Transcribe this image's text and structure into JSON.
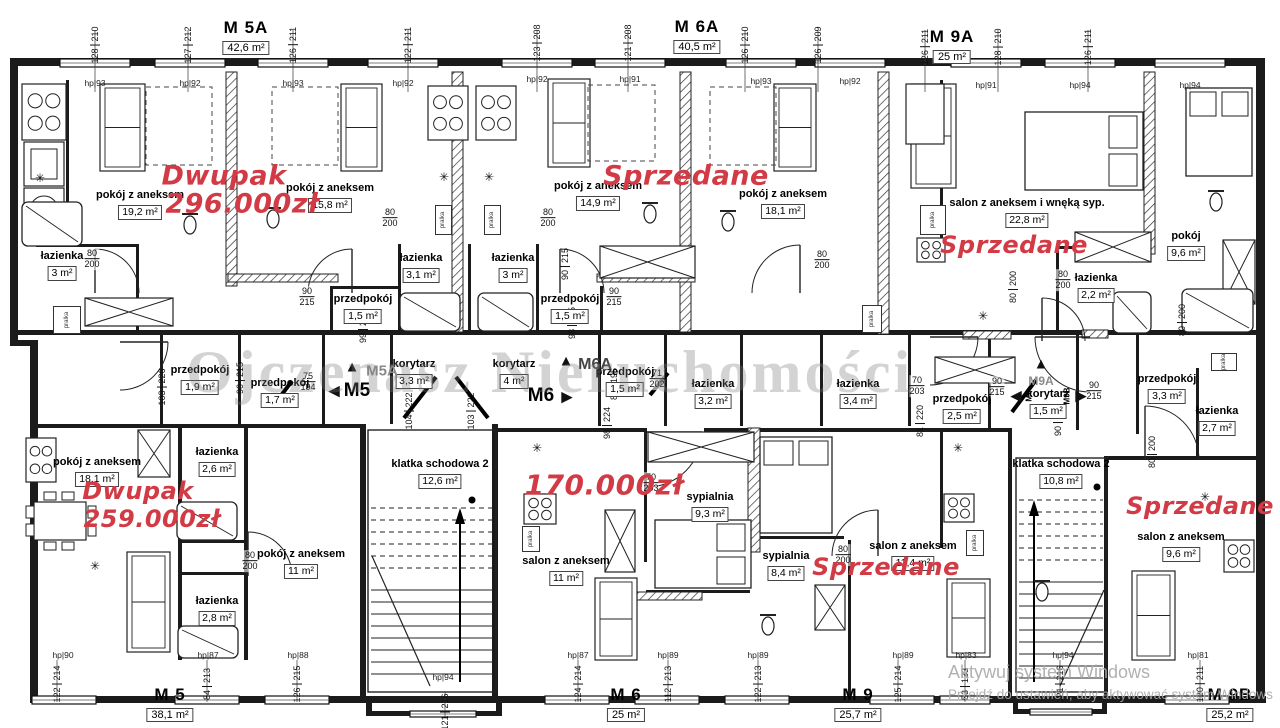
{
  "watermark": {
    "text": "Ojczenasz Nieruchomości"
  },
  "windows_notice": {
    "line1": "Aktywuj system Windows",
    "line2": "Przejdź do ustawień, aby aktywować system Windows"
  },
  "colors": {
    "annotation_red": "#d23b45",
    "wall_black": "#1b1b1b",
    "watermark_gray": "#7a7a7a"
  },
  "units": [
    {
      "name": "M 5A",
      "area": "42,6 m²",
      "x": 246,
      "y": 18
    },
    {
      "name": "M 6A",
      "area": "40,5 m²",
      "x": 697,
      "y": 17
    },
    {
      "name": "M 9A",
      "area": "25 m²",
      "x": 952,
      "y": 27
    },
    {
      "name": "M 5",
      "area": "38,1 m²",
      "x": 170,
      "y": 685
    },
    {
      "name": "M 6",
      "area": "25 m²",
      "x": 626,
      "y": 685
    },
    {
      "name": "M 9",
      "area": "25,7 m²",
      "x": 858,
      "y": 685
    },
    {
      "name": "M 9B",
      "area": "25,2 m²",
      "x": 1230,
      "y": 685
    }
  ],
  "rooms": [
    {
      "name": "pokój z aneksem",
      "area": "19,2 m²",
      "x": 140,
      "y": 190
    },
    {
      "name": "pokój z aneksem",
      "area": "15,8 m²",
      "x": 330,
      "y": 183
    },
    {
      "name": "pokój z aneksem",
      "area": "14,9 m²",
      "x": 598,
      "y": 181
    },
    {
      "name": "pokój z aneksem",
      "area": "18,1 m²",
      "x": 783,
      "y": 189
    },
    {
      "name": "salon z aneksem i wnęką syp.",
      "area": "22,8 m²",
      "x": 1027,
      "y": 198
    },
    {
      "name": "pokój",
      "area": "9,6 m²",
      "x": 1186,
      "y": 231
    },
    {
      "name": "łazienka",
      "area": "3 m²",
      "x": 62,
      "y": 251
    },
    {
      "name": "łazienka",
      "area": "3,1 m²",
      "x": 421,
      "y": 253
    },
    {
      "name": "łazienka",
      "area": "3 m²",
      "x": 513,
      "y": 253
    },
    {
      "name": "łazienka",
      "area": "2,2 m²",
      "x": 1096,
      "y": 273
    },
    {
      "name": "przedpokój",
      "area": "1,5 m²",
      "x": 363,
      "y": 294
    },
    {
      "name": "przedpokój",
      "area": "1,5 m²",
      "x": 570,
      "y": 294
    },
    {
      "name": "przedpokój",
      "area": "1,9 m²",
      "x": 200,
      "y": 365
    },
    {
      "name": "przedpokój",
      "area": "1,7 m²",
      "x": 280,
      "y": 378
    },
    {
      "name": "korytarz",
      "area": "3,3 m²",
      "x": 414,
      "y": 359
    },
    {
      "name": "korytarz",
      "area": "4 m²",
      "x": 514,
      "y": 359
    },
    {
      "name": "przedpokój",
      "area": "1,5 m²",
      "x": 625,
      "y": 367
    },
    {
      "name": "łazienka",
      "area": "3,2 m²",
      "x": 713,
      "y": 379
    },
    {
      "name": "łazienka",
      "area": "3,4 m²",
      "x": 858,
      "y": 379
    },
    {
      "name": "przedpokój",
      "area": "2,5 m²",
      "x": 962,
      "y": 394
    },
    {
      "name": "korytarz",
      "area": "1,5 m²",
      "x": 1048,
      "y": 389
    },
    {
      "name": "przedpokój",
      "area": "3,3 m²",
      "x": 1167,
      "y": 374
    },
    {
      "name": "łazienka",
      "area": "2,7 m²",
      "x": 1217,
      "y": 406
    },
    {
      "name": "pokój z aneksem",
      "area": "18,1 m²",
      "x": 97,
      "y": 457
    },
    {
      "name": "łazienka",
      "area": "2,6 m²",
      "x": 217,
      "y": 447
    },
    {
      "name": "łazienka",
      "area": "2,8 m²",
      "x": 217,
      "y": 596
    },
    {
      "name": "pokój z aneksem",
      "area": "11 m²",
      "x": 301,
      "y": 549
    },
    {
      "name": "klatka schodowa 2",
      "area": "12,6 m²",
      "x": 440,
      "y": 459
    },
    {
      "name": "salon z aneksem",
      "area": "11 m²",
      "x": 566,
      "y": 556
    },
    {
      "name": "sypialnia",
      "area": "9,3 m²",
      "x": 710,
      "y": 492
    },
    {
      "name": "sypialnia",
      "area": "8,4 m²",
      "x": 786,
      "y": 551
    },
    {
      "name": "salon z aneksem",
      "area": "11,4 m²",
      "x": 913,
      "y": 541
    },
    {
      "name": "klatka schodowa 2",
      "area": "10,8 m²",
      "x": 1061,
      "y": 459
    },
    {
      "name": "salon z aneksem",
      "area": "9,6 m²",
      "x": 1181,
      "y": 532
    }
  ],
  "annotations": [
    {
      "text": "Dwupak",
      "kind": "price",
      "x": 224,
      "y": 176,
      "size": 27
    },
    {
      "text": "296.000zł",
      "kind": "price",
      "x": 242,
      "y": 204,
      "size": 27
    },
    {
      "text": "Sprzedane",
      "kind": "status",
      "x": 686,
      "y": 176,
      "size": 27
    },
    {
      "text": "Sprzedane",
      "kind": "status",
      "x": 1014,
      "y": 245,
      "size": 24
    },
    {
      "text": "Dwupak",
      "kind": "price",
      "x": 138,
      "y": 491,
      "size": 24
    },
    {
      "text": "259.000zł",
      "kind": "price",
      "x": 152,
      "y": 519,
      "size": 24
    },
    {
      "text": "170.000zł",
      "kind": "price",
      "x": 604,
      "y": 485,
      "size": 28
    },
    {
      "text": "Sprzedane",
      "kind": "status",
      "x": 886,
      "y": 567,
      "size": 24
    },
    {
      "text": "Sprzedane",
      "kind": "status",
      "x": 1200,
      "y": 506,
      "size": 24
    }
  ],
  "markers": [
    {
      "glyph": "▲",
      "tx": 352,
      "ty": 367,
      "label": "M5A",
      "lx": 382,
      "ly": 371,
      "size": 15,
      "color": "#8a8a8a",
      "rot": false
    },
    {
      "glyph": "◀",
      "tx": 334,
      "ty": 391,
      "label": "M5",
      "lx": 357,
      "ly": 391,
      "size": 19,
      "color": "#000000",
      "rot": false
    },
    {
      "glyph": "▲",
      "tx": 566,
      "ty": 361,
      "label": "M6A",
      "lx": 595,
      "ly": 365,
      "size": 16,
      "color": "#444444",
      "rot": false
    },
    {
      "glyph": "▶",
      "tx": 567,
      "ty": 397,
      "label": "M6",
      "lx": 541,
      "ly": 396,
      "size": 19,
      "color": "#000000",
      "rot": false
    },
    {
      "glyph": "▲",
      "tx": 1041,
      "ty": 364,
      "label": "M9A",
      "lx": 1041,
      "ly": 381,
      "size": 12,
      "color": "#8a8a8a",
      "rot": false
    },
    {
      "glyph": "◀",
      "tx": 1016,
      "ty": 396,
      "label": "M9",
      "lx": 1029,
      "ly": 396,
      "size": 8,
      "color": "#000000",
      "rot": true
    },
    {
      "glyph": "▶",
      "tx": 1081,
      "ty": 396,
      "label": "M9B",
      "lx": 1067,
      "ly": 396,
      "size": 8,
      "color": "#000000",
      "rot": true
    }
  ],
  "hp_labels": [
    {
      "text": "hp|93",
      "x": 95,
      "y": 78
    },
    {
      "text": "hp|92",
      "x": 190,
      "y": 78
    },
    {
      "text": "hp|93",
      "x": 293,
      "y": 78
    },
    {
      "text": "hp|92",
      "x": 403,
      "y": 78
    },
    {
      "text": "hp|92",
      "x": 537,
      "y": 74
    },
    {
      "text": "hp|91",
      "x": 630,
      "y": 74
    },
    {
      "text": "hp|93",
      "x": 761,
      "y": 76
    },
    {
      "text": "hp|92",
      "x": 850,
      "y": 76
    },
    {
      "text": "hp|91",
      "x": 986,
      "y": 80
    },
    {
      "text": "hp|94",
      "x": 1080,
      "y": 80
    },
    {
      "text": "hp|94",
      "x": 1190,
      "y": 80
    },
    {
      "text": "hp|90",
      "x": 63,
      "y": 650
    },
    {
      "text": "hp|87",
      "x": 208,
      "y": 650
    },
    {
      "text": "hp|88",
      "x": 298,
      "y": 650
    },
    {
      "text": "hp|94",
      "x": 443,
      "y": 672
    },
    {
      "text": "hp|87",
      "x": 578,
      "y": 650
    },
    {
      "text": "hp|89",
      "x": 668,
      "y": 650
    },
    {
      "text": "hp|89",
      "x": 758,
      "y": 650
    },
    {
      "text": "hp|89",
      "x": 903,
      "y": 650
    },
    {
      "text": "hp|83",
      "x": 966,
      "y": 650
    },
    {
      "text": "hp|94",
      "x": 1063,
      "y": 650
    },
    {
      "text": "hp|81",
      "x": 1198,
      "y": 650
    }
  ],
  "dims_top": [
    {
      "x": 95,
      "y": 45,
      "a": "128",
      "b": "210"
    },
    {
      "x": 188,
      "y": 45,
      "a": "127",
      "b": "212"
    },
    {
      "x": 293,
      "y": 45,
      "a": "126",
      "b": "211"
    },
    {
      "x": 408,
      "y": 45,
      "a": "122",
      "b": "211"
    },
    {
      "x": 537,
      "y": 43,
      "a": "123",
      "b": "208"
    },
    {
      "x": 628,
      "y": 43,
      "a": "121",
      "b": "208"
    },
    {
      "x": 745,
      "y": 45,
      "a": "126",
      "b": "210"
    },
    {
      "x": 818,
      "y": 45,
      "a": "126",
      "b": "209"
    },
    {
      "x": 925,
      "y": 47,
      "a": "126",
      "b": "211"
    },
    {
      "x": 998,
      "y": 47,
      "a": "128",
      "b": "210"
    },
    {
      "x": 1088,
      "y": 47,
      "a": "126",
      "b": "211"
    }
  ],
  "dims_bottom": [
    {
      "x": 57,
      "y": 684,
      "a": "122",
      "b": "214"
    },
    {
      "x": 207,
      "y": 684,
      "a": "84",
      "b": "213"
    },
    {
      "x": 297,
      "y": 684,
      "a": "126",
      "b": "215"
    },
    {
      "x": 445,
      "y": 712,
      "a": "121",
      "b": "216"
    },
    {
      "x": 578,
      "y": 684,
      "a": "124",
      "b": "214"
    },
    {
      "x": 668,
      "y": 684,
      "a": "112",
      "b": "213"
    },
    {
      "x": 758,
      "y": 684,
      "a": "122",
      "b": "213"
    },
    {
      "x": 898,
      "y": 684,
      "a": "125",
      "b": "214"
    },
    {
      "x": 965,
      "y": 684,
      "a": "53",
      "b": "133"
    },
    {
      "x": 1060,
      "y": 684,
      "a": "121",
      "b": "216"
    },
    {
      "x": 1200,
      "y": 684,
      "a": "120",
      "b": "211"
    }
  ],
  "dims_inner": [
    {
      "x": 363,
      "y": 327,
      "a": "99",
      "b": "223"
    },
    {
      "x": 572,
      "y": 323,
      "a": "98",
      "b": "225"
    },
    {
      "x": 162,
      "y": 387,
      "a": "103",
      "b": "226"
    },
    {
      "x": 240,
      "y": 378,
      "a": "90",
      "b": "215"
    },
    {
      "x": 409,
      "y": 411,
      "a": "104",
      "b": "222"
    },
    {
      "x": 471,
      "y": 411,
      "a": "103",
      "b": "222"
    },
    {
      "x": 607,
      "y": 423,
      "a": "98",
      "b": "224"
    },
    {
      "x": 614,
      "y": 384,
      "a": "85",
      "b": "195"
    },
    {
      "x": 920,
      "y": 421,
      "a": "81",
      "b": "220"
    },
    {
      "x": 1058,
      "y": 420,
      "a": "90",
      "b": "226"
    },
    {
      "x": 1182,
      "y": 320,
      "a": "80",
      "b": "200"
    },
    {
      "x": 1152,
      "y": 452,
      "a": "80",
      "b": "200"
    },
    {
      "x": 1013,
      "y": 287,
      "a": "80",
      "b": "200"
    },
    {
      "x": 565,
      "y": 264,
      "a": "90",
      "b": "215"
    }
  ],
  "door_dims": [
    {
      "x": 92,
      "y": 259,
      "a": "80",
      "b": "200"
    },
    {
      "x": 307,
      "y": 297,
      "a": "90",
      "b": "215"
    },
    {
      "x": 614,
      "y": 297,
      "a": "90",
      "b": "215"
    },
    {
      "x": 390,
      "y": 218,
      "a": "80",
      "b": "200"
    },
    {
      "x": 548,
      "y": 218,
      "a": "80",
      "b": "200"
    },
    {
      "x": 822,
      "y": 260,
      "a": "80",
      "b": "200"
    },
    {
      "x": 1063,
      "y": 280,
      "a": "80",
      "b": "200"
    },
    {
      "x": 250,
      "y": 561,
      "a": "80",
      "b": "200"
    },
    {
      "x": 843,
      "y": 555,
      "a": "80",
      "b": "200"
    },
    {
      "x": 651,
      "y": 483,
      "a": "70",
      "b": "203"
    },
    {
      "x": 917,
      "y": 386,
      "a": "70",
      "b": "203"
    },
    {
      "x": 997,
      "y": 387,
      "a": "90",
      "b": "215"
    },
    {
      "x": 1094,
      "y": 391,
      "a": "90",
      "b": "215"
    },
    {
      "x": 657,
      "y": 379,
      "a": "71",
      "b": "202"
    },
    {
      "x": 308,
      "y": 382,
      "a": "75",
      "b": "194"
    }
  ],
  "symbols": [
    {
      "glyph": "✳",
      "x": 40,
      "y": 178
    },
    {
      "glyph": "✳",
      "x": 444,
      "y": 177
    },
    {
      "glyph": "✳",
      "x": 489,
      "y": 177
    },
    {
      "glyph": "✳",
      "x": 983,
      "y": 316
    },
    {
      "glyph": "✳",
      "x": 95,
      "y": 566
    },
    {
      "glyph": "✳",
      "x": 537,
      "y": 448
    },
    {
      "glyph": "✳",
      "x": 958,
      "y": 448
    },
    {
      "glyph": "✳",
      "x": 1205,
      "y": 497
    }
  ],
  "washer_label": "pralka",
  "washers": [
    {
      "x": 53,
      "y": 306,
      "w": 26,
      "h": 26
    },
    {
      "x": 435,
      "y": 205,
      "w": 15,
      "h": 28
    },
    {
      "x": 484,
      "y": 205,
      "w": 15,
      "h": 28
    },
    {
      "x": 920,
      "y": 205,
      "w": 24,
      "h": 28
    },
    {
      "x": 862,
      "y": 305,
      "w": 18,
      "h": 26
    },
    {
      "x": 522,
      "y": 526,
      "w": 16,
      "h": 24
    },
    {
      "x": 1211,
      "y": 353,
      "w": 24,
      "h": 16
    },
    {
      "x": 966,
      "y": 530,
      "w": 16,
      "h": 24
    }
  ]
}
